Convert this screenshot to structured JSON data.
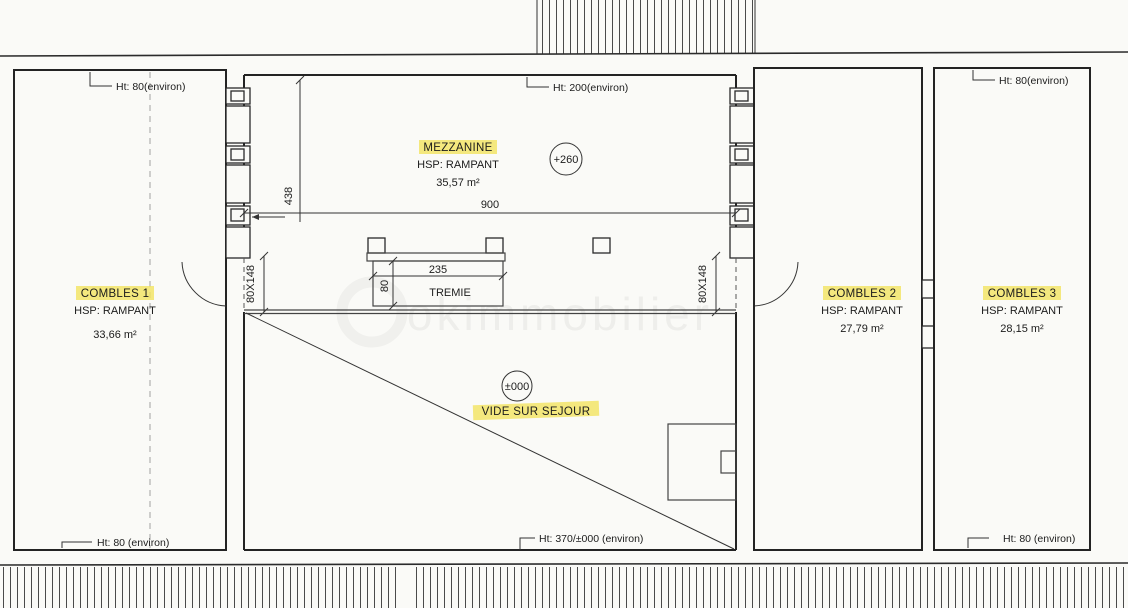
{
  "plan": {
    "height_labels": {
      "combles1_top": "Ht: 80(environ)",
      "mezzanine_top": "Ht: 200(environ)",
      "combles3_top": "Ht: 80(environ)",
      "combles1_bottom": "Ht: 80 (environ)",
      "vide_bottom": "Ht: 370/±000 (environ)",
      "combles3_bottom": "Ht: 80 (environ)"
    },
    "rooms": {
      "combles1": {
        "name": "COMBLES 1",
        "ceiling": "HSP: RAMPANT",
        "area": "33,66 m²"
      },
      "mezzanine": {
        "name": "MEZZANINE",
        "ceiling": "HSP: RAMPANT",
        "area": "35,57 m²"
      },
      "combles2": {
        "name": "COMBLES 2",
        "ceiling": "HSP: RAMPANT",
        "area": "27,79 m²"
      },
      "combles3": {
        "name": "COMBLES 3",
        "ceiling": "HSP: RAMPANT",
        "area": "28,15 m²"
      }
    },
    "annotations": {
      "void": "VIDE SUR SEJOUR",
      "tremie": "TREMIE",
      "level_mezzanine": "+260",
      "level_main": "±000"
    },
    "dimensions": {
      "mezzanine_width": "900",
      "mezzanine_depth": "438",
      "tremie_width": "235",
      "tremie_height": "80",
      "opening_left": "80X148",
      "opening_right": "80X148"
    },
    "watermark": "okimmobilier",
    "colors": {
      "highlight": "#f2e35f",
      "ink": "#1f1f1f"
    }
  }
}
